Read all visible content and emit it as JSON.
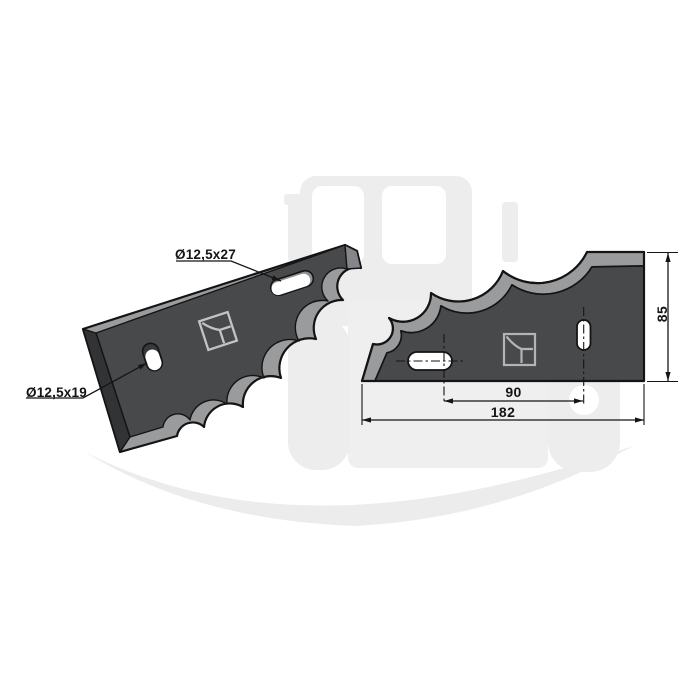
{
  "views": {
    "perspective": {
      "hole_label_top": "Ø12,5x27",
      "hole_label_left": "Ø12,5x19"
    },
    "front": {
      "dim_hole_spacing": "90",
      "dim_overall_length": "182",
      "dim_height": "85"
    }
  },
  "colors": {
    "blade_face": "#48494b",
    "blade_side": "#323335",
    "blade_bevel": "#9a9b9d",
    "outline": "#141414",
    "hole_fill": "#ffffff",
    "logo_stroke": "#b8b9bb",
    "watermark": "#ededed"
  },
  "icons": {
    "brand_logo": "square-with-curve-logo",
    "watermark_image": "tractor-silhouette"
  }
}
